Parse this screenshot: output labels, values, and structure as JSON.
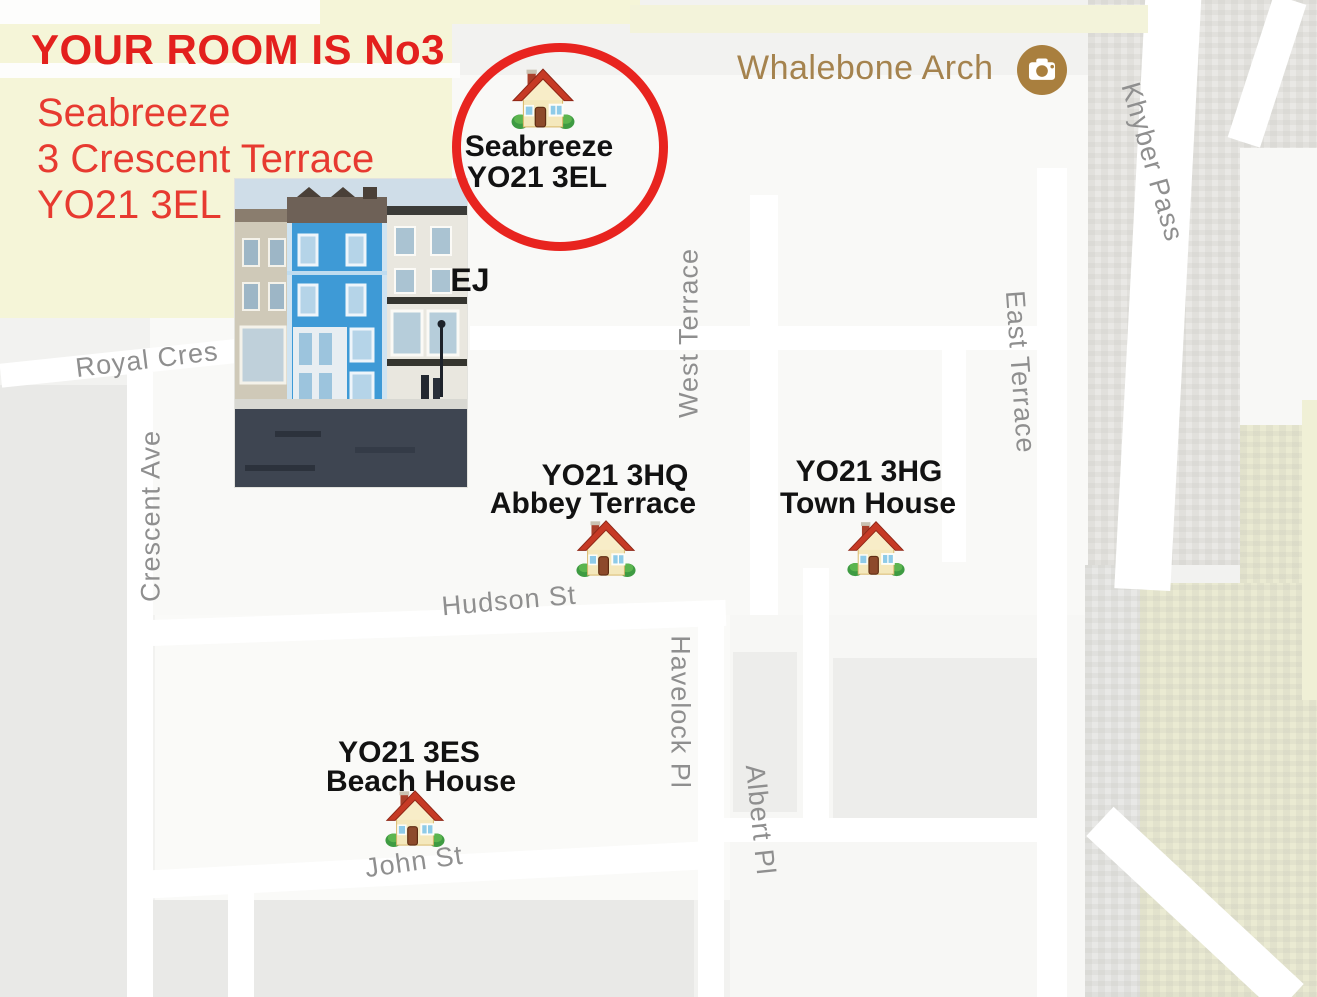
{
  "annotation": {
    "title": "YOUR ROOM IS No3",
    "address": [
      "Seabreeze",
      "3 Crescent Terrace",
      "YO21 3EL"
    ]
  },
  "target": {
    "name": "Seabreeze",
    "postcode": "YO21 3EL"
  },
  "landmark": {
    "name": "Whalebone Arch"
  },
  "partial_label": "EJ",
  "properties": [
    {
      "postcode": "YO21 3HQ",
      "name": "Abbey Terrace"
    },
    {
      "postcode": "YO21 3HG",
      "name": "Town House"
    },
    {
      "postcode": "YO21 3ES",
      "name": "Beach House"
    }
  ],
  "streets": {
    "royal_cres": "Royal Cres",
    "crescent_ave": "Crescent Ave",
    "west_terrace": "West Terrace",
    "east_terrace": "East Terrace",
    "khyber_pass": "Khyber Pass",
    "hudson_st": "Hudson St",
    "havelock_pl": "Havelock Pl",
    "albert_pl": "Albert Pl",
    "john_st": "John St"
  },
  "colors": {
    "annotation_red": "#e6231f",
    "highlight_circle_red": "#e8241f",
    "label_black": "#121212",
    "street_gray": "#8f8f8f",
    "landmark_brown": "#a5834e",
    "map_yellow": "#f5f5d8",
    "map_olive": "#eaead2",
    "road_white": "#ffffff"
  }
}
